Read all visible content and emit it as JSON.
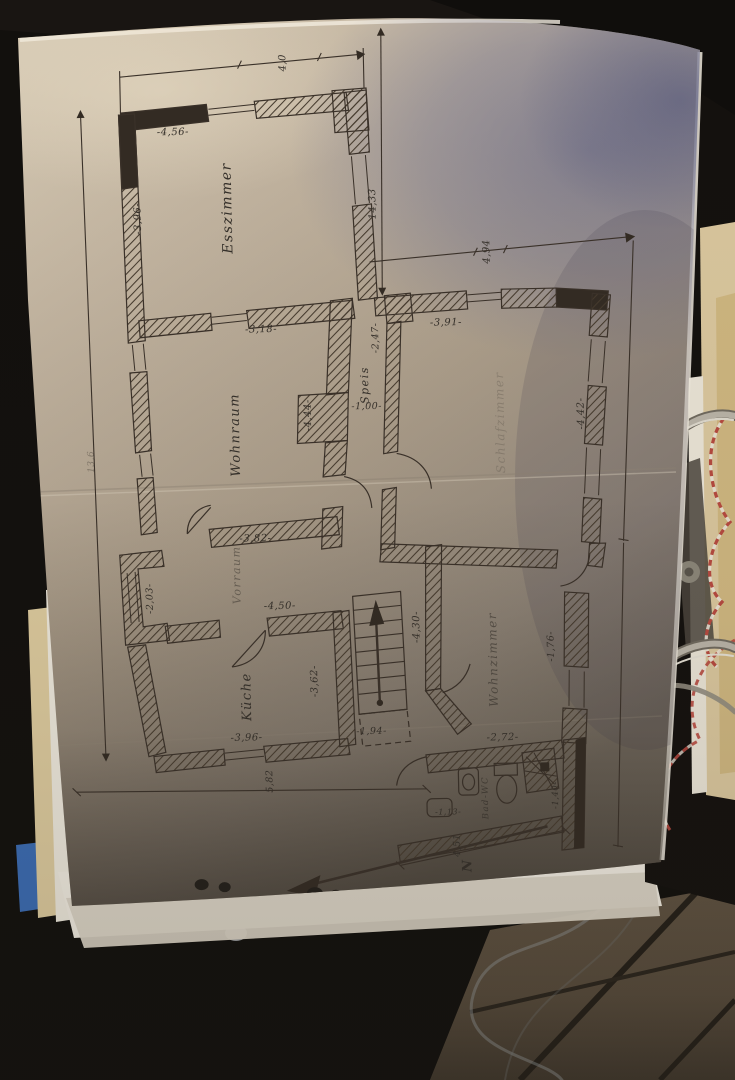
{
  "scene": {
    "description": "photo of hand-drawn floor plan page in a ring binder on dark tiled floor",
    "paper_color": "#b7a994",
    "ink_color": "#35302a",
    "blue_shadow_color": "#6e7092",
    "binder_ring_color": "#a8a296",
    "string_colors": [
      "#b5493f",
      "#e8e0d4"
    ],
    "blue_tab_color": "#3a6ab0",
    "cream_paper_color": "#d8c59c",
    "tile_color": "#5e5140"
  },
  "labels": {
    "rooms": {
      "esszimmer": "Esszimmer",
      "wohnraum": "Wohnraum",
      "schlafzimmer": "Schlafzimmer",
      "speis": "Speis",
      "vorraum": "Vorraum",
      "kueche": "Küche",
      "wohnzimmer": "Wohnzimmer",
      "bad": "Bad-WC"
    },
    "dims": {
      "d40": "4,0",
      "d456": "-4,56-",
      "d396ess": "-3,96-",
      "d1433": "14,33",
      "d494": "4,94",
      "d318": "-3,18-",
      "d391": "-3,91-",
      "d247": "-2,47-",
      "d100": "-1,00-",
      "d444": "-4,44-",
      "d442": "-4,42-",
      "d382": "-3,82-",
      "d203": "-2,03-",
      "d450": "-4,50-",
      "d430": "-4,30-",
      "d362": "-3,62-",
      "d396k": "-3,96-",
      "d194": "-1,94-",
      "d582": "5,82",
      "d176": "-1,76-",
      "d272": "-2,72-",
      "d113": "-1,13-",
      "d140": "-1,40-",
      "d451": "4,51",
      "d136": "13,6"
    },
    "north": "N"
  }
}
